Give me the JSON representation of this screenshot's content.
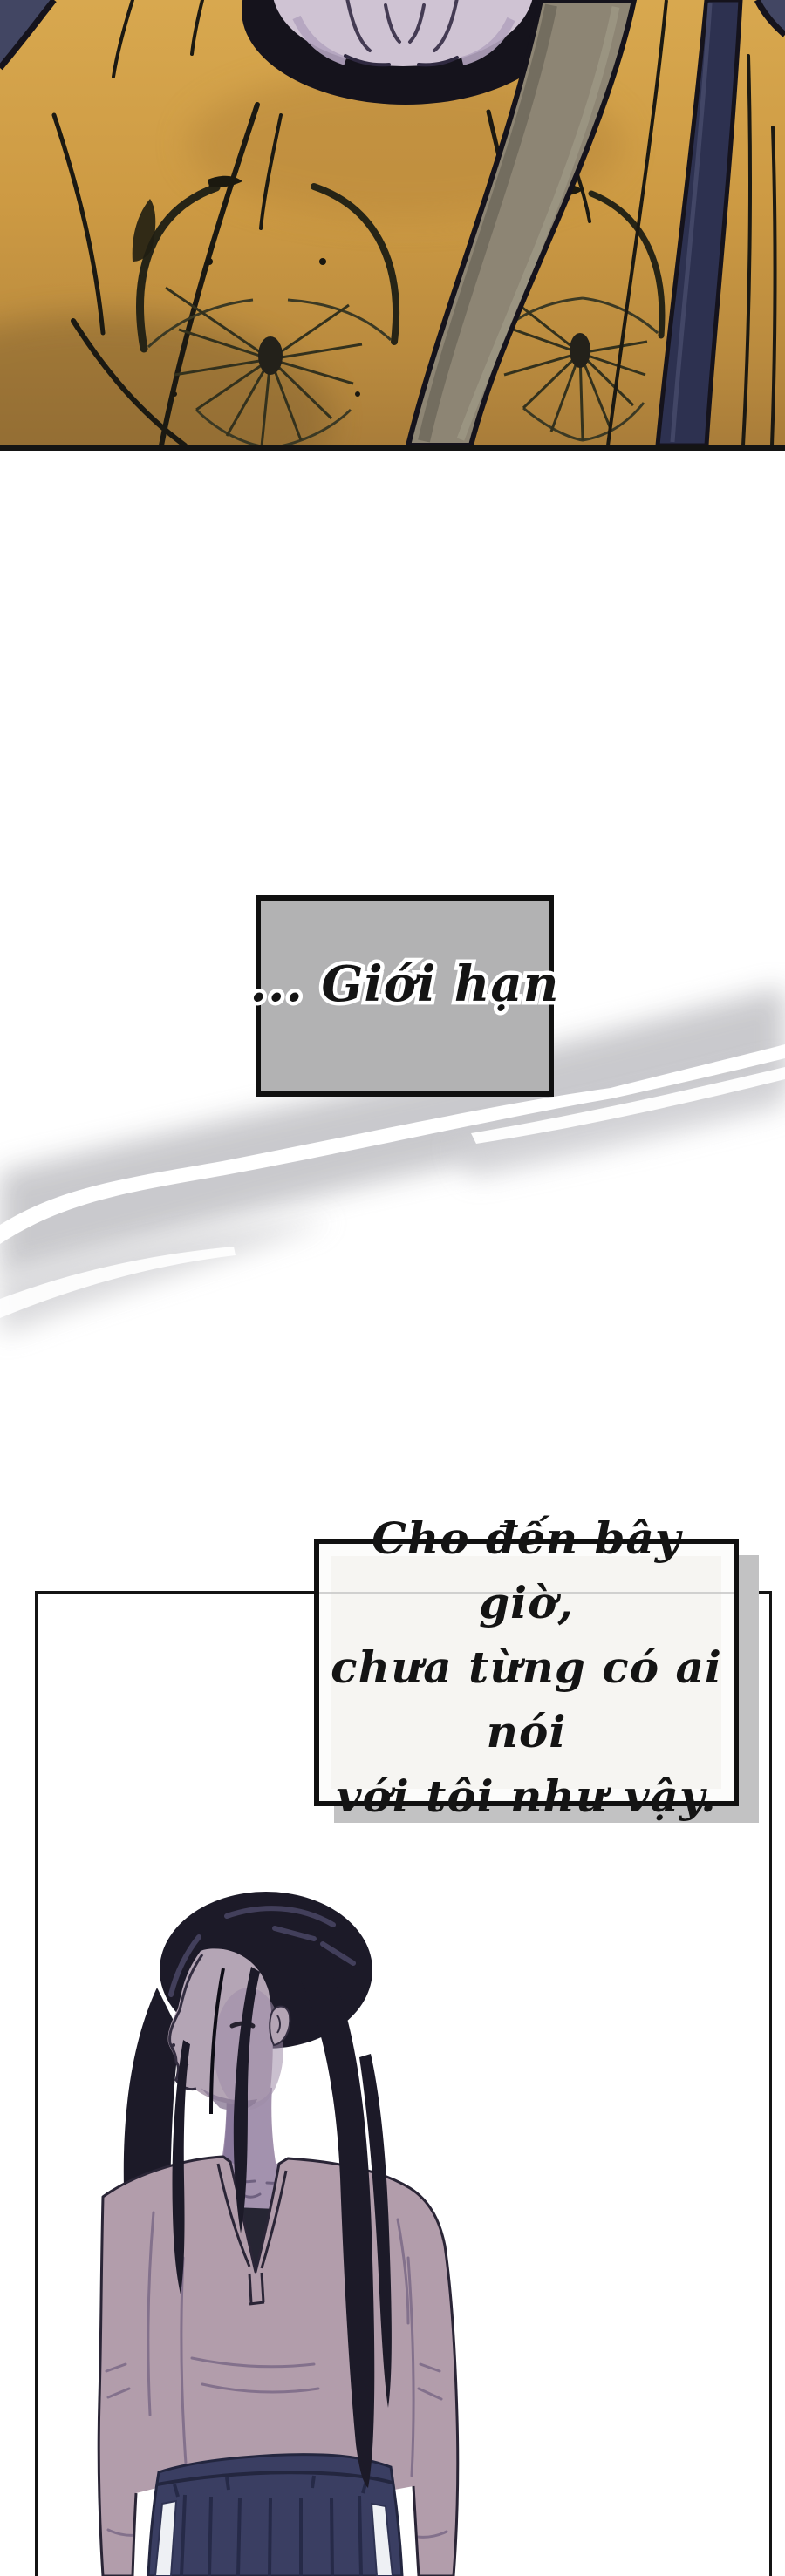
{
  "narration": {
    "box1_text": "... Giới hạn",
    "box2_lines": [
      "Cho đến bây giờ,",
      "chưa từng có ai nói",
      "với tôi như vậy."
    ]
  },
  "colors": {
    "page_bg": "#ffffff",
    "ink": "#141414",
    "panel_border": "#141414",
    "narration_box1_fill": "#b2b2b3",
    "narration_box2_fill": "#fcfcfb",
    "narration_box2_shadow": "#c2c2c3",
    "torn_band_gray": "#c7c7cb",
    "shirt_yellow": "#cf9b44",
    "backdrop_navy": "#424663",
    "bag_strap_gray": "#8d8574",
    "bag_strap_navy": "#2d3150",
    "butterfly_print": "#33311d",
    "skin_lavender": "#cfc3d3",
    "woman_hair": "#1c1a28",
    "woman_skin": "#b4a5b5",
    "woman_shirt": "#b29dab",
    "woman_skirt_navy": "#3a3e62",
    "skirt_stripe": "#eef0f4"
  }
}
